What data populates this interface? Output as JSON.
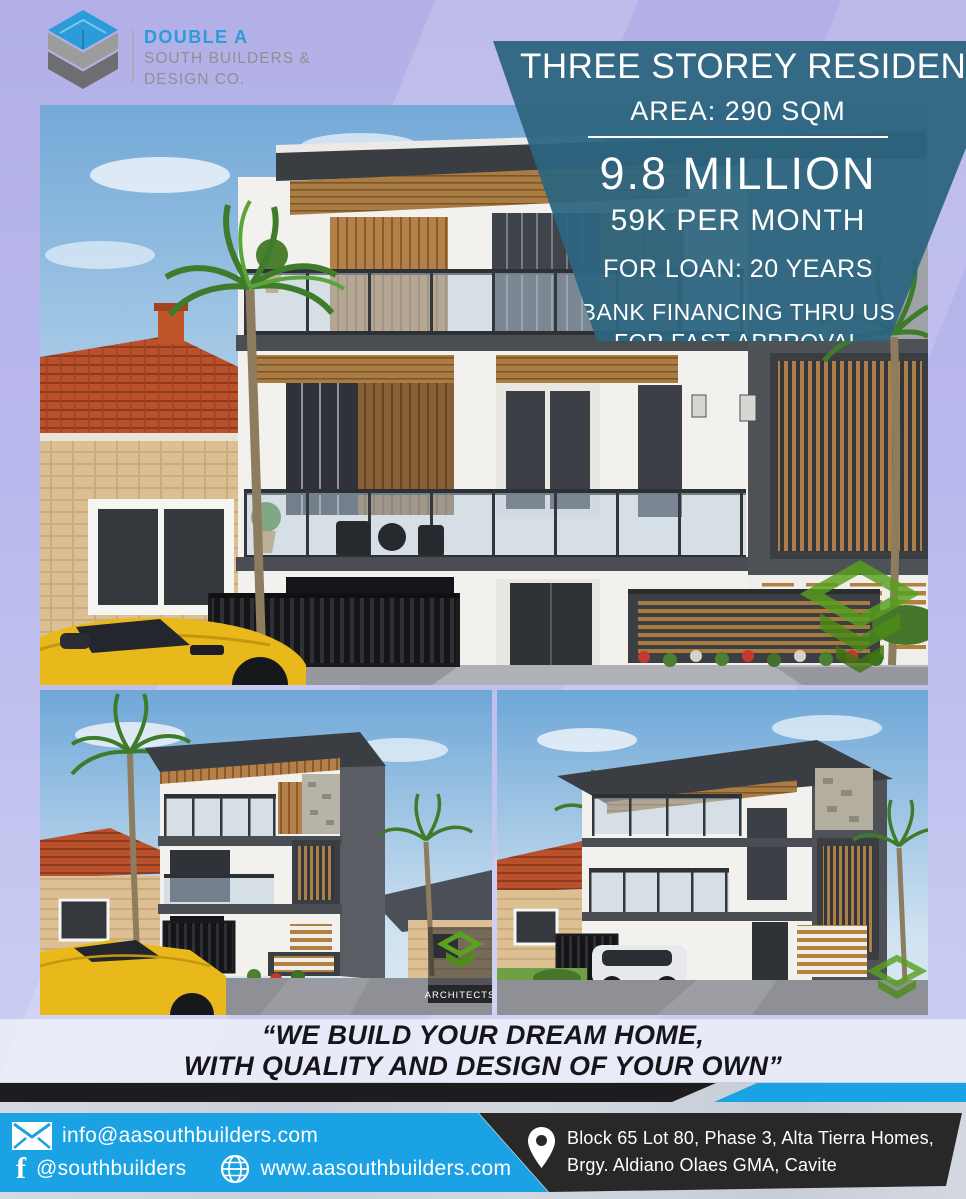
{
  "brand": {
    "line1": "DOUBLE A",
    "line2": "SOUTH BUILDERS &",
    "line3": "DESIGN CO.",
    "logo_blue": "#2b9cd8",
    "logo_gray_light": "#9c9c9c",
    "logo_gray_dark": "#6e6e72"
  },
  "banner": {
    "title": "THREE STOREY RESIDENTIAL",
    "area": "AREA: 290 SQM",
    "price": "9.8 MILLION",
    "monthly": "59K PER MONTH",
    "loan": "FOR LOAN: 20 YEARS",
    "financing1": "BANK FINANCING THRU US",
    "financing2": "FOR FAST APPROVAL",
    "bg_color": "#2d6580"
  },
  "gallery": {
    "main_view": "three storey house front elevation render",
    "left_view": "house left angle render",
    "right_view": "house right angle render",
    "watermark": "ARCHITECTS",
    "watermark_green": "#57a01e"
  },
  "quote": {
    "line1": "“WE BUILD YOUR DREAM HOME,",
    "line2": "WITH QUALITY AND DESIGN OF YOUR OWN”"
  },
  "contact": {
    "email": "info@aasouthbuilders.com",
    "facebook": "@southbuilders",
    "website": "www.aasouthbuilders.com",
    "address1": "Block 65 Lot 80, Phase 3, Alta Tierra Homes,",
    "address2": "Brgy. Aldiano Olaes GMA, Cavite",
    "bar_blue": "#1ba2e4",
    "bar_dark": "#282828"
  }
}
